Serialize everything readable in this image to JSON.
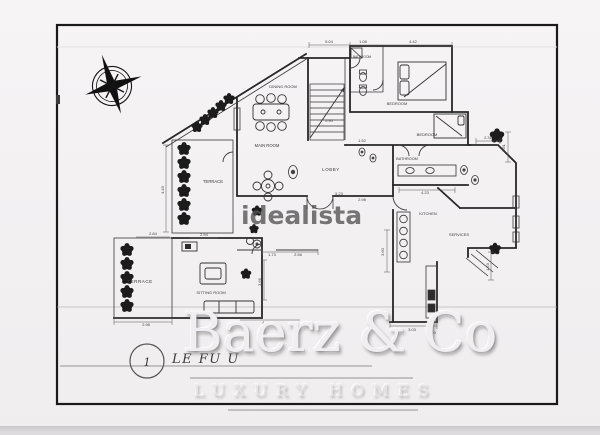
{
  "document": {
    "colors": {
      "paper": "#f3f1f2",
      "ink": "#2a2a2a",
      "border": "#1b1b1b",
      "watermark_gray": "#525252",
      "emboss_light": "#f0eef0",
      "scan_strip": "#d9d7da"
    },
    "rooms": [
      {
        "label": "DINING ROOM"
      },
      {
        "label": "MAIN ROOM"
      },
      {
        "label": "LOBBY"
      },
      {
        "label": "BEDROOM"
      },
      {
        "label": "BEDROOM"
      },
      {
        "label": "BATHROOM"
      },
      {
        "label": "BATHROOM"
      },
      {
        "label": "KITCHEN"
      },
      {
        "label": "SERVICES"
      },
      {
        "label": "TERRACE"
      },
      {
        "label": "TERRACE"
      },
      {
        "label": "SITTING ROOM"
      }
    ],
    "dimensions": [
      "5.04",
      "1.08",
      "4.42",
      "0.90",
      "1.52",
      "2.31",
      "4.23",
      "5.23",
      "2.98",
      "1.73",
      "2.56",
      "3.66",
      "3.60",
      "2.84",
      "2.98",
      "4.43",
      "2.94",
      "3.03",
      "1.00",
      "1.81",
      "1.53",
      "4.40"
    ],
    "floor_badge": {
      "number": "1",
      "title": "LE FU U"
    },
    "icons": {
      "compass": "compass-rose"
    }
  },
  "watermarks": {
    "center_logo": "idealista",
    "brand": "Baerz & Co",
    "brand_tagline": "LUXURY HOMES"
  }
}
